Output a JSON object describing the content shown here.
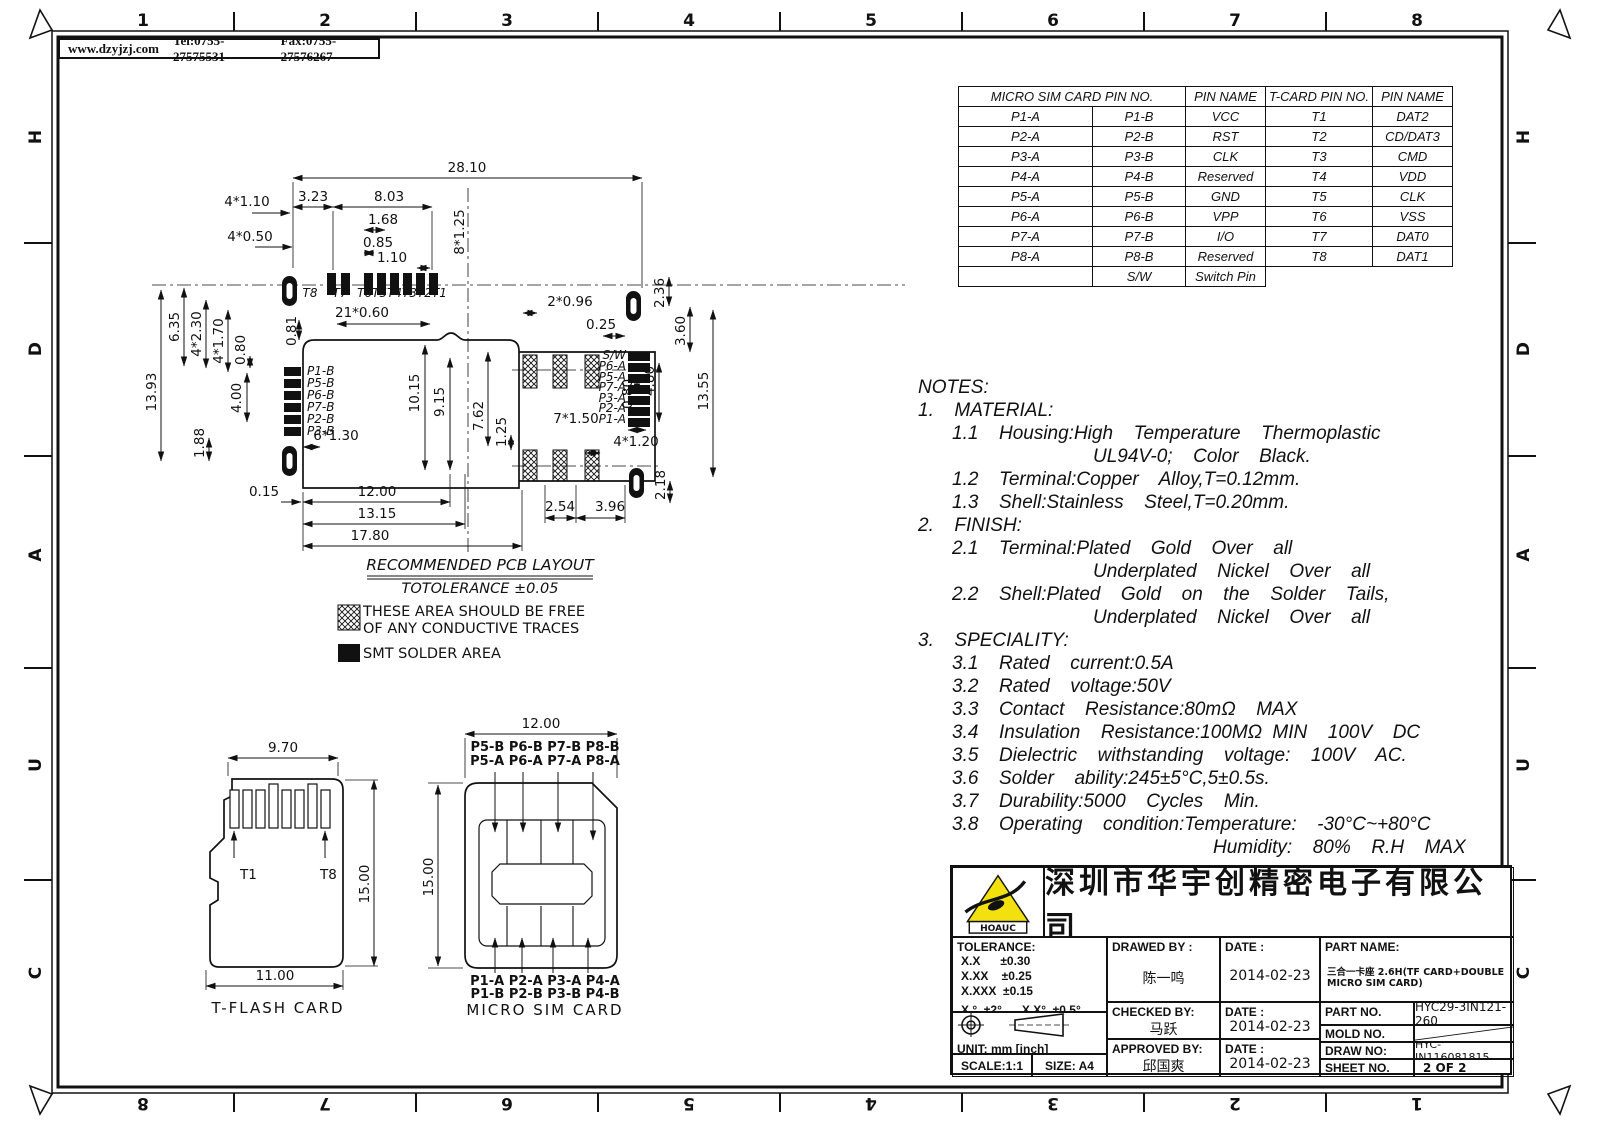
{
  "sheet_header": {
    "url": "www.dzyjzj.com",
    "tel": "Tel:0755-27575531",
    "fax": "Fax:0755-27576267"
  },
  "frame": {
    "top_zones": [
      "1",
      "2",
      "3",
      "4",
      "5",
      "6",
      "7",
      "8"
    ],
    "bottom_zones": [
      "8",
      "7",
      "6",
      "5",
      "4",
      "3",
      "2",
      "1"
    ],
    "left_zones": [
      "H",
      "D",
      "A",
      "U",
      "C"
    ],
    "right_zones": [
      "H",
      "D",
      "A",
      "U",
      "C"
    ]
  },
  "pin_table": {
    "headers": [
      "MICRO SIM CARD PIN NO.",
      "PIN NAME",
      "T-CARD PIN NO.",
      "PIN NAME"
    ],
    "rows": [
      [
        "P1-A",
        "P1-B",
        "VCC",
        "T1",
        "DAT2"
      ],
      [
        "P2-A",
        "P2-B",
        "RST",
        "T2",
        "CD/DAT3"
      ],
      [
        "P3-A",
        "P3-B",
        "CLK",
        "T3",
        "CMD"
      ],
      [
        "P4-A",
        "P4-B",
        "Reserved",
        "T4",
        "VDD"
      ],
      [
        "P5-A",
        "P5-B",
        "GND",
        "T5",
        "CLK"
      ],
      [
        "P6-A",
        "P6-B",
        "VPP",
        "T6",
        "VSS"
      ],
      [
        "P7-A",
        "P7-B",
        "I/O",
        "T7",
        "DAT0"
      ],
      [
        "P8-A",
        "P8-B",
        "Reserved",
        "T8",
        "DAT1"
      ],
      [
        "",
        "S/W",
        "Switch Pin",
        "",
        ""
      ]
    ]
  },
  "notes": {
    "lines": [
      "NOTES:",
      "1.  MATERIAL:",
      "1.1  Housing:High  Temperature  Thermoplastic",
      "UL94V-0;  Color  Black.",
      "1.2  Terminal:Copper  Alloy,T=0.12mm.",
      "1.3  Shell:Stainless  Steel,T=0.20mm.",
      "2.  FINISH:",
      "2.1  Terminal:Plated  Gold  Over  all",
      "Underplated  Nickel  Over  all",
      "2.2  Shell:Plated  Gold  on  the  Solder  Tails,",
      "Underplated  Nickel  Over  all",
      "3.  SPECIALITY:",
      "3.1  Rated  current:0.5A",
      "3.2  Rated  voltage:50V",
      "3.3  Contact  Resistance:80mΩ  MAX",
      "3.4  Insulation  Resistance:100MΩ MIN  100V  DC",
      "3.5  Dielectric  withstanding  voltage:  100V  AC.",
      "3.6  Solder  ability:245±5°C,5±0.5s.",
      "3.7  Durability:5000  Cycles  Min.",
      "3.8  Operating  condition:Temperature:  -30°C~+80°C",
      "Humidity:  80%  R.H  MAX"
    ]
  },
  "pcb": {
    "title": "RECOMMENDED PCB LAYOUT",
    "tolerance_note": "TOTOLERANCE ±0.05",
    "legend_keepout_1": "THESE AREA SHOULD BE FREE",
    "legend_keepout_2": "OF ANY CONDUCTIVE TRACES",
    "legend_smt": "SMT SOLDER AREA",
    "t_pads": {
      "t8": "T8",
      "t7": "T7",
      "t6_t1": "T6T5T4T3T2T1"
    },
    "left_pads": [
      "P1-B",
      "P5-B",
      "P6-B",
      "P7-B",
      "P2-B",
      "P3-B"
    ],
    "right_pads": [
      "S/W",
      "P6-A",
      "P5-A",
      "P7-A",
      "P3-A",
      "P2-A",
      "P1-A"
    ],
    "dims": {
      "w_overall": "28.10",
      "w323": "3.23",
      "w803": "8.03",
      "w168": "1.68",
      "w085": "0.85",
      "w110": "1.10",
      "n4x110": "4*1.10",
      "n4x050": "4*0.50",
      "n8x125": "8*1.25",
      "n21x060": "21*0.60",
      "v081": "0.81",
      "v635": "6.35",
      "n4x230": "4*2.30",
      "n4x170": "4*1.70",
      "v080l": "0.80",
      "v1393": "13.93",
      "v400": "4.00",
      "v188": "1.88",
      "v1015": "10.15",
      "v915": "9.15",
      "n6x130": "6*1.30",
      "w015": "0.15",
      "w1200": "12.00",
      "w1315": "13.15",
      "w1780": "17.80",
      "n2x096": "2*0.96",
      "w025": "0.25",
      "v236": "2.36",
      "v360": "3.60",
      "v480": "4.80",
      "v080r": "0.80",
      "v1355": "13.55",
      "n7x150": "7*1.50",
      "n4x120": "4*1.20",
      "v762": "7.62",
      "v125": "1.25",
      "w254": "2.54",
      "w396": "3.96",
      "v218": "2.18"
    }
  },
  "tflash": {
    "title": "T-FLASH CARD",
    "dim_top": "9.70",
    "dim_height": "15.00",
    "dim_bottom": "11.00",
    "pin_first": "T1",
    "pin_last": "T8"
  },
  "microsim": {
    "title": "MICRO SIM CARD",
    "dim_width": "12.00",
    "dim_height": "15.00",
    "top_row_b": "P5-B P6-B P7-B P8-B",
    "top_row_a": "P5-A P6-A P7-A P8-A",
    "bottom_row_a": "P1-A P2-A P3-A P4-A",
    "bottom_row_b": "P1-B P2-B P3-B P4-B"
  },
  "title_block": {
    "logo_text": "HOAUC",
    "company": "深圳市华宇创精密电子有限公司",
    "tolerance_title": "TOLERANCE:",
    "tol_rows": [
      "X.X      ±0.30",
      "X.XX    ±0.25",
      "X.XXX  ±0.15"
    ],
    "tol_ang": "X.°  ±2°      X.X°  ±0.5°",
    "unit": "UNIT:  mm  [inch]",
    "scale": "SCALE:1:1",
    "size": "SIZE:  A4",
    "drawed_by_label": "DRAWED BY :",
    "drawed_by": "陈一鸣",
    "checked_by_label": "CHECKED BY:",
    "checked_by": "马跃",
    "approved_by_label": "APPROVED BY:",
    "approved_by": "邱国爽",
    "date_label": "DATE :",
    "date_drawed": "2014-02-23",
    "date_checked": "2014-02-23",
    "date_approved": "2014-02-23",
    "part_name_label": "PART NAME:",
    "part_name": "三合一卡座 2.6H(TF CARD+DOUBLE MICRO SIM CARD)",
    "part_no_label": "PART NO.",
    "part_no": "HYC29-3IN121-260",
    "mold_no_label": "MOLD NO.",
    "draw_no_label": "DRAW NO:",
    "draw_no": "HYC-IN116081815",
    "sheet_no_label": "SHEET NO.",
    "sheet_no": "2 OF 2"
  },
  "colors": {
    "line": "#1a1a1a",
    "logo_yellow": "#f2e10e",
    "paper": "#ffffff"
  }
}
